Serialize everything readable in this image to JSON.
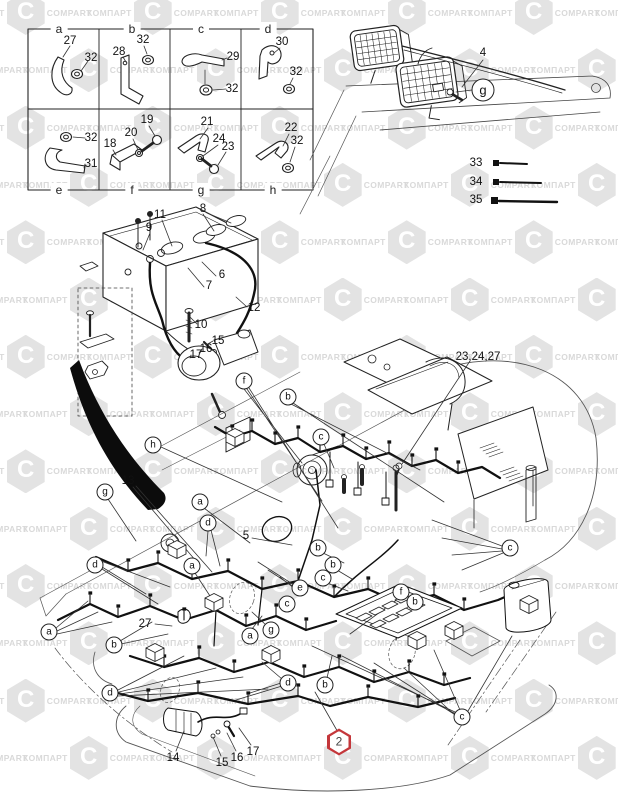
{
  "watermark": {
    "word_cyrillic": "КОМПАРТ",
    "word_latin": "COMPART",
    "logo_letter": "C",
    "color": "#d9d9d9"
  },
  "colors": {
    "ink": "#1f1f1f",
    "thin_line": "#555555",
    "harness": "#101010",
    "badge_red": "#c4373b",
    "paper": "#ffffff"
  },
  "callouts": [
    {
      "t": "a",
      "x": 59,
      "y": 29,
      "k": "grid"
    },
    {
      "t": "b",
      "x": 132,
      "y": 29,
      "k": "grid"
    },
    {
      "t": "c",
      "x": 201,
      "y": 29,
      "k": "grid"
    },
    {
      "t": "d",
      "x": 268,
      "y": 29,
      "k": "grid"
    },
    {
      "t": "e",
      "x": 59,
      "y": 190,
      "k": "grid"
    },
    {
      "t": "f",
      "x": 132,
      "y": 190,
      "k": "grid"
    },
    {
      "t": "g",
      "x": 201,
      "y": 190,
      "k": "grid"
    },
    {
      "t": "h",
      "x": 273,
      "y": 190,
      "k": "grid"
    },
    {
      "t": "27",
      "x": 70,
      "y": 41,
      "k": "num"
    },
    {
      "t": "32",
      "x": 91,
      "y": 58,
      "k": "num"
    },
    {
      "t": "28",
      "x": 119,
      "y": 52,
      "k": "num"
    },
    {
      "t": "32",
      "x": 143,
      "y": 40,
      "k": "num"
    },
    {
      "t": "29",
      "x": 233,
      "y": 57,
      "k": "num"
    },
    {
      "t": "32",
      "x": 232,
      "y": 89,
      "k": "num"
    },
    {
      "t": "30",
      "x": 282,
      "y": 42,
      "k": "num"
    },
    {
      "t": "32",
      "x": 296,
      "y": 72,
      "k": "num"
    },
    {
      "t": "32",
      "x": 91,
      "y": 138,
      "k": "num"
    },
    {
      "t": "31",
      "x": 91,
      "y": 164,
      "k": "num"
    },
    {
      "t": "19",
      "x": 147,
      "y": 120,
      "k": "num"
    },
    {
      "t": "20",
      "x": 131,
      "y": 133,
      "k": "num"
    },
    {
      "t": "18",
      "x": 110,
      "y": 144,
      "k": "num"
    },
    {
      "t": "21",
      "x": 207,
      "y": 122,
      "k": "num"
    },
    {
      "t": "24",
      "x": 219,
      "y": 139,
      "k": "num"
    },
    {
      "t": "23",
      "x": 228,
      "y": 147,
      "k": "num"
    },
    {
      "t": "22",
      "x": 291,
      "y": 128,
      "k": "num"
    },
    {
      "t": "32",
      "x": 297,
      "y": 141,
      "k": "num"
    },
    {
      "t": "4",
      "x": 483,
      "y": 53,
      "k": "num"
    },
    {
      "t": "g",
      "x": 483,
      "y": 90,
      "k": "letL"
    },
    {
      "t": "33",
      "x": 476,
      "y": 163,
      "k": "num"
    },
    {
      "t": "34",
      "x": 476,
      "y": 182,
      "k": "num"
    },
    {
      "t": "35",
      "x": 476,
      "y": 200,
      "k": "num"
    },
    {
      "t": "8",
      "x": 203,
      "y": 209,
      "k": "num"
    },
    {
      "t": "11",
      "x": 160,
      "y": 215,
      "k": "num"
    },
    {
      "t": "9",
      "x": 149,
      "y": 228,
      "k": "num"
    },
    {
      "t": "6",
      "x": 222,
      "y": 275,
      "k": "num"
    },
    {
      "t": "7",
      "x": 209,
      "y": 286,
      "k": "num"
    },
    {
      "t": "12",
      "x": 254,
      "y": 308,
      "k": "num"
    },
    {
      "t": "10",
      "x": 201,
      "y": 325,
      "k": "num"
    },
    {
      "t": "15",
      "x": 218,
      "y": 341,
      "k": "num"
    },
    {
      "t": "16",
      "x": 206,
      "y": 349,
      "k": "num"
    },
    {
      "t": "17",
      "x": 196,
      "y": 355,
      "k": "num"
    },
    {
      "t": "23,24,27",
      "x": 478,
      "y": 357,
      "k": "num"
    },
    {
      "t": "13",
      "x": 128,
      "y": 481,
      "k": "num"
    },
    {
      "t": "5",
      "x": 246,
      "y": 536,
      "k": "num"
    },
    {
      "t": "27",
      "x": 145,
      "y": 624,
      "k": "num"
    },
    {
      "t": "14",
      "x": 173,
      "y": 758,
      "k": "num"
    },
    {
      "t": "15",
      "x": 222,
      "y": 763,
      "k": "num"
    },
    {
      "t": "16",
      "x": 237,
      "y": 758,
      "k": "num"
    },
    {
      "t": "17",
      "x": 253,
      "y": 752,
      "k": "num"
    },
    {
      "t": "f",
      "x": 244,
      "y": 381,
      "k": "let"
    },
    {
      "t": "b",
      "x": 288,
      "y": 397,
      "k": "let"
    },
    {
      "t": "c",
      "x": 321,
      "y": 437,
      "k": "let"
    },
    {
      "t": "h",
      "x": 153,
      "y": 445,
      "k": "let"
    },
    {
      "t": "g",
      "x": 105,
      "y": 492,
      "k": "let"
    },
    {
      "t": "a",
      "x": 200,
      "y": 502,
      "k": "let"
    },
    {
      "t": "d",
      "x": 208,
      "y": 523,
      "k": "let"
    },
    {
      "t": "b",
      "x": 318,
      "y": 548,
      "k": "let"
    },
    {
      "t": "c",
      "x": 510,
      "y": 548,
      "k": "let"
    },
    {
      "t": "d",
      "x": 95,
      "y": 565,
      "k": "let"
    },
    {
      "t": "a",
      "x": 192,
      "y": 566,
      "k": "let"
    },
    {
      "t": "b",
      "x": 333,
      "y": 565,
      "k": "let"
    },
    {
      "t": "c",
      "x": 323,
      "y": 578,
      "k": "let"
    },
    {
      "t": "e",
      "x": 300,
      "y": 588,
      "k": "let"
    },
    {
      "t": "c",
      "x": 287,
      "y": 604,
      "k": "let"
    },
    {
      "t": "f",
      "x": 401,
      "y": 592,
      "k": "let"
    },
    {
      "t": "b",
      "x": 415,
      "y": 602,
      "k": "let"
    },
    {
      "t": "a",
      "x": 49,
      "y": 632,
      "k": "let"
    },
    {
      "t": "g",
      "x": 271,
      "y": 630,
      "k": "let"
    },
    {
      "t": "a",
      "x": 250,
      "y": 636,
      "k": "let"
    },
    {
      "t": "b",
      "x": 114,
      "y": 645,
      "k": "let"
    },
    {
      "t": "d",
      "x": 110,
      "y": 693,
      "k": "let"
    },
    {
      "t": "d",
      "x": 288,
      "y": 683,
      "k": "let"
    },
    {
      "t": "b",
      "x": 325,
      "y": 685,
      "k": "let"
    },
    {
      "t": "c",
      "x": 462,
      "y": 717,
      "k": "let"
    },
    {
      "t": "2",
      "x": 339,
      "y": 742,
      "k": "hex"
    }
  ]
}
